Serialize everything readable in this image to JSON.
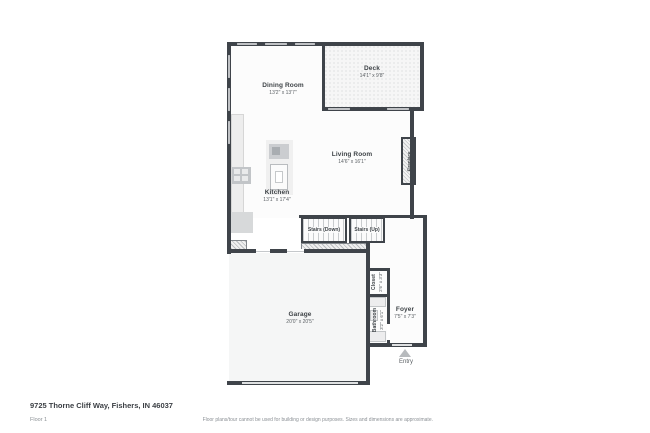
{
  "palette": {
    "wall": "#3f444a",
    "window_fill": "#d8dadc",
    "room_fill": "#fcfcfc",
    "garage_fill": "#f5f6f6",
    "hatch": "#b9bcbf",
    "label_text": "#3e4347",
    "muted_text": "#8b9095"
  },
  "rooms": {
    "dining": {
      "name": "Dining Room",
      "dims": "13'2\" x 13'7\""
    },
    "deck": {
      "name": "Deck",
      "dims": "14'1\" x 9'8\""
    },
    "living": {
      "name": "Living Room",
      "dims": "14'6\" x 16'1\""
    },
    "kitchen": {
      "name": "Kitchen",
      "dims": "13'1\" x 17'4\""
    },
    "garage": {
      "name": "Garage",
      "dims": "20'0\" x 20'5\""
    },
    "foyer": {
      "name": "Foyer",
      "dims": "7'5\" x 7'3\""
    },
    "closet": {
      "name": "Closet",
      "dims": "2'6\" x 3'3\""
    },
    "bathroom": {
      "name": "Bathroom",
      "dims": "3'2\" x 6'1\""
    },
    "stairs_down": {
      "name": "Stairs (Down)"
    },
    "stairs_up": {
      "name": "Stairs (Up)"
    },
    "fireplace": {
      "name": "Fireplace"
    },
    "entry": {
      "name": "Entry"
    }
  },
  "icons": {
    "entry_arrow": "triangle-up"
  },
  "footer": {
    "address": "9725 Thorne Cliff Way, Fishers, IN 46037",
    "floor_label": "Floor 1",
    "disclaimer": "Floor plans/tour cannot be used for building or design purposes. Sizes and dimensions are approximate."
  }
}
